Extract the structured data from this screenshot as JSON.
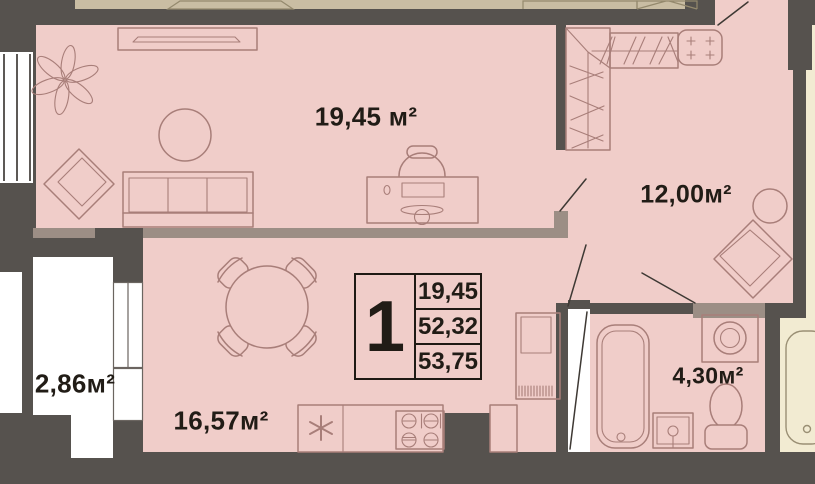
{
  "colors": {
    "wall": "#56524e",
    "room-fill": "#f0cdc9",
    "adjacent-top": "#c9bda3",
    "adjacent-right": "#f2ebd2",
    "partition": "#9c8e85",
    "furniture-line": "#a87e79",
    "adjacent-line": "#94896d",
    "door-line": "#3e3934",
    "text": "#211c16",
    "white": "#ffffff"
  },
  "rooms": {
    "living": {
      "area_label": "19,45 м²"
    },
    "bedroom": {
      "area_label": "12,00м²"
    },
    "kitchen": {
      "area_label": "16,57м²"
    },
    "balcony": {
      "area_label": "2,86м²"
    },
    "bathroom": {
      "area_label": "4,30м²"
    }
  },
  "legend": {
    "rooms_count": "1",
    "values": [
      "19,45",
      "52,32",
      "53,75"
    ]
  }
}
